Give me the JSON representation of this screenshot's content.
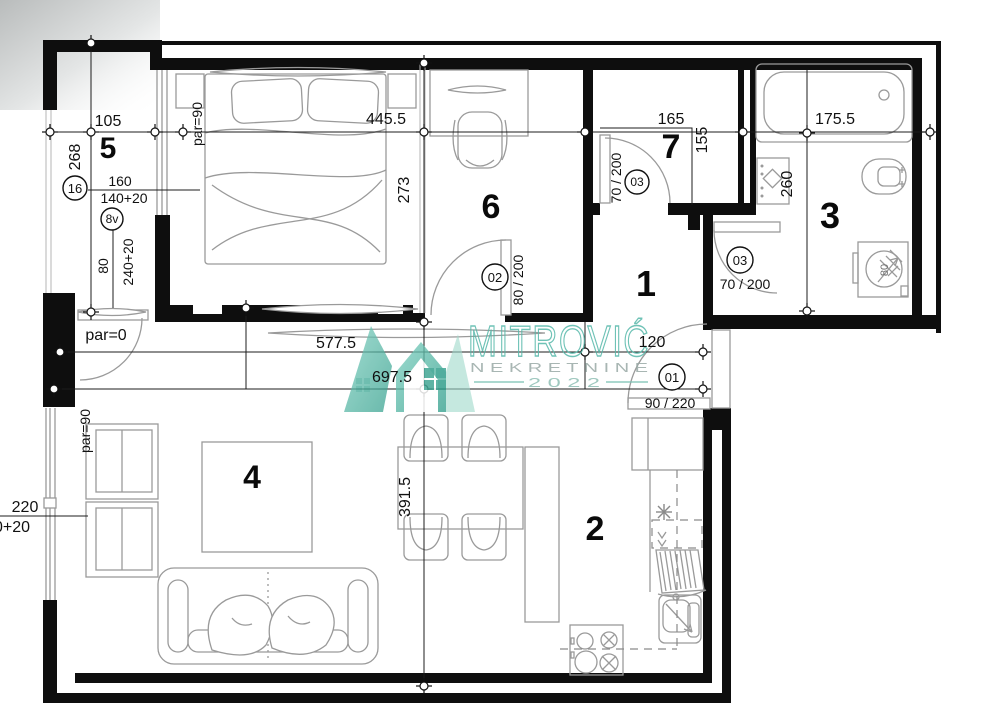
{
  "watermark": {
    "brand": "MITROVIĆ",
    "subtitle": "N E K R E T N I N E",
    "year": "2 0 2 2",
    "accent_color": "#56b8aa"
  },
  "rooms": {
    "hall": "1",
    "kitchen": "2",
    "bathroom": "3",
    "living": "4",
    "loggia": "5",
    "bedroom": "6",
    "closet": "7"
  },
  "dims": {
    "d105": "105",
    "d268": "268",
    "par90_top": "par=90",
    "d4455": "445.5",
    "d273": "273",
    "d165": "165",
    "d155": "155",
    "d1755": "175.5",
    "d260": "260",
    "c16": "16",
    "d160": "160",
    "d140": "140+20",
    "c8v": "8v",
    "d80v": "80",
    "d240": "240+20",
    "par0": "par=0",
    "d5775": "577.5",
    "d6975": "697.5",
    "d120": "120",
    "par90_left": "par=90",
    "d220": "220",
    "d0p20": "0+20",
    "d3915": "391.5",
    "washer80": "80"
  },
  "doors": {
    "d01": {
      "no": "01",
      "size": "90 / 220"
    },
    "d02": {
      "no": "02",
      "size": "80 / 200"
    },
    "d03_closet": {
      "no": "03",
      "size": "70 / 200"
    },
    "d03_bath": {
      "no": "03",
      "size": "70 / 200"
    }
  }
}
